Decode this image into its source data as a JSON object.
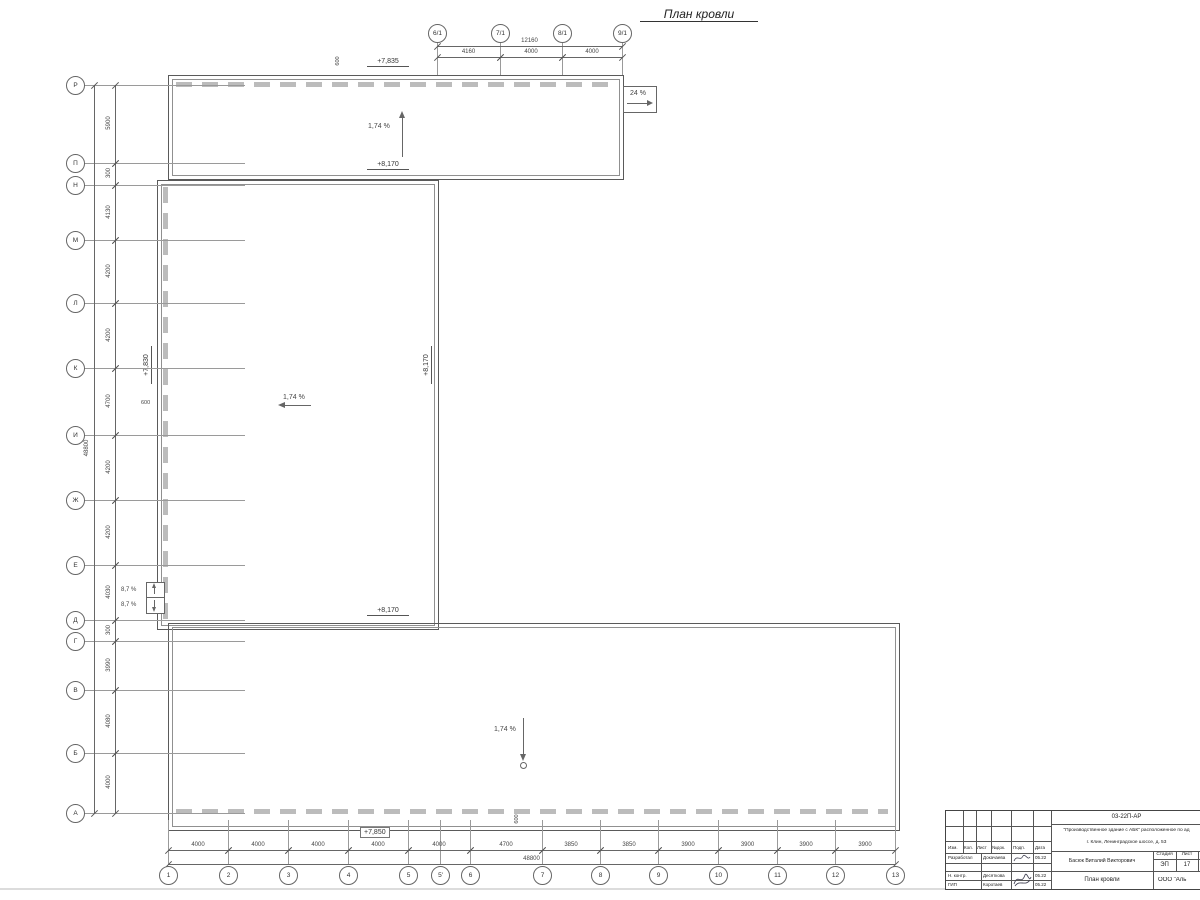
{
  "marks": {
    "title": "План кровли",
    "elev_top": "+7,835",
    "elev_top_bottom": "+8,170",
    "elev_mid_left": "+7,830",
    "elev_mid_right": "+8,170",
    "elev_bottom_top": "+8,170",
    "elev_bottom": "+7,850",
    "slope_main": "1,74 %",
    "slope_ramp": "24 %",
    "slope_funnel": "8,7 %",
    "dim600": "600"
  },
  "axes": {
    "left": [
      {
        "label": "Р",
        "y": 85
      },
      {
        "label": "П",
        "y": 163
      },
      {
        "label": "Н",
        "y": 185
      },
      {
        "label": "М",
        "y": 240
      },
      {
        "label": "Л",
        "y": 303
      },
      {
        "label": "К",
        "y": 368
      },
      {
        "label": "И",
        "y": 435
      },
      {
        "label": "Ж",
        "y": 500
      },
      {
        "label": "Е",
        "y": 565
      },
      {
        "label": "Д",
        "y": 620
      },
      {
        "label": "Г",
        "y": 641
      },
      {
        "label": "В",
        "y": 690
      },
      {
        "label": "Б",
        "y": 753
      },
      {
        "label": "А",
        "y": 813
      }
    ],
    "top": [
      {
        "label": "6/1",
        "x": 437
      },
      {
        "label": "7/1",
        "x": 500
      },
      {
        "label": "8/1",
        "x": 562
      },
      {
        "label": "9/1",
        "x": 622
      }
    ],
    "bottom": [
      {
        "label": "1",
        "x": 168
      },
      {
        "label": "2",
        "x": 228
      },
      {
        "label": "3",
        "x": 288
      },
      {
        "label": "4",
        "x": 348
      },
      {
        "label": "5",
        "x": 408
      },
      {
        "label": "5'",
        "x": 440
      },
      {
        "label": "6",
        "x": 470
      },
      {
        "label": "7",
        "x": 542
      },
      {
        "label": "8",
        "x": 600
      },
      {
        "label": "9",
        "x": 658
      },
      {
        "label": "10",
        "x": 718
      },
      {
        "label": "11",
        "x": 777
      },
      {
        "label": "12",
        "x": 835
      },
      {
        "label": "13",
        "x": 895
      }
    ]
  },
  "dims": {
    "left": {
      "segments": [
        {
          "from": 85,
          "to": 163,
          "label": "5900"
        },
        {
          "from": 163,
          "to": 185,
          "label": "300"
        },
        {
          "from": 185,
          "to": 240,
          "label": "4130"
        },
        {
          "from": 240,
          "to": 303,
          "label": "4200"
        },
        {
          "from": 303,
          "to": 368,
          "label": "4200"
        },
        {
          "from": 368,
          "to": 435,
          "label": "4700"
        },
        {
          "from": 435,
          "to": 500,
          "label": "4200"
        },
        {
          "from": 500,
          "to": 565,
          "label": "4200"
        },
        {
          "from": 565,
          "to": 620,
          "label": "4030"
        },
        {
          "from": 620,
          "to": 641,
          "label": "300"
        },
        {
          "from": 641,
          "to": 690,
          "label": "3990"
        },
        {
          "from": 690,
          "to": 753,
          "label": "4080"
        },
        {
          "from": 753,
          "to": 813,
          "label": "4000"
        }
      ],
      "total": {
        "from": 85,
        "to": 813,
        "label": "48800"
      }
    },
    "bottom": {
      "segments": [
        {
          "from": 168,
          "to": 228,
          "label": "4000"
        },
        {
          "from": 228,
          "to": 288,
          "label": "4000"
        },
        {
          "from": 288,
          "to": 348,
          "label": "4000"
        },
        {
          "from": 348,
          "to": 408,
          "label": "4000"
        },
        {
          "from": 408,
          "to": 470,
          "label": "4000"
        },
        {
          "from": 470,
          "to": 542,
          "label": "4700"
        },
        {
          "from": 542,
          "to": 600,
          "label": "3850"
        },
        {
          "from": 600,
          "to": 658,
          "label": "3850"
        },
        {
          "from": 658,
          "to": 718,
          "label": "3900"
        },
        {
          "from": 718,
          "to": 777,
          "label": "3900"
        },
        {
          "from": 777,
          "to": 835,
          "label": "3900"
        },
        {
          "from": 835,
          "to": 895,
          "label": "3900"
        }
      ],
      "total": {
        "from": 168,
        "to": 895,
        "label": "48800"
      }
    },
    "top": {
      "segments": [
        {
          "from": 437,
          "to": 500,
          "label": "4160"
        },
        {
          "from": 500,
          "to": 562,
          "label": "4000"
        },
        {
          "from": 562,
          "to": 622,
          "label": "4000"
        }
      ],
      "total": {
        "from": 437,
        "to": 622,
        "label": "12160"
      }
    }
  },
  "stamp": {
    "doc_number": "03-22П-АР",
    "project_line1": "\"Производственное здание с АБК\" расположенное по ад",
    "project_line2": "г. Клин, Ленинградское шоссе, д. 53",
    "header": {
      "izm": "Изм.",
      "kol": "Кол.",
      "list": "Лист",
      "ndok": "№док.",
      "podp": "Подп.",
      "data": "Дата"
    },
    "rows": [
      {
        "role": "Разработал",
        "name": "Докачаева",
        "date": "05.22"
      },
      {
        "role": "Н. контр.",
        "name": "Десяткова",
        "date": "05.22"
      },
      {
        "role": "ГИП",
        "name": "Коротаев",
        "date": "05.22"
      }
    ],
    "person": "Басюк Виталий Викторович",
    "stage_label": "Стадия",
    "sheet_label": "Лист",
    "stage": "ЭП",
    "sheet": "17",
    "sheet_title": "План кровли",
    "company": "ООО \"Аль"
  }
}
